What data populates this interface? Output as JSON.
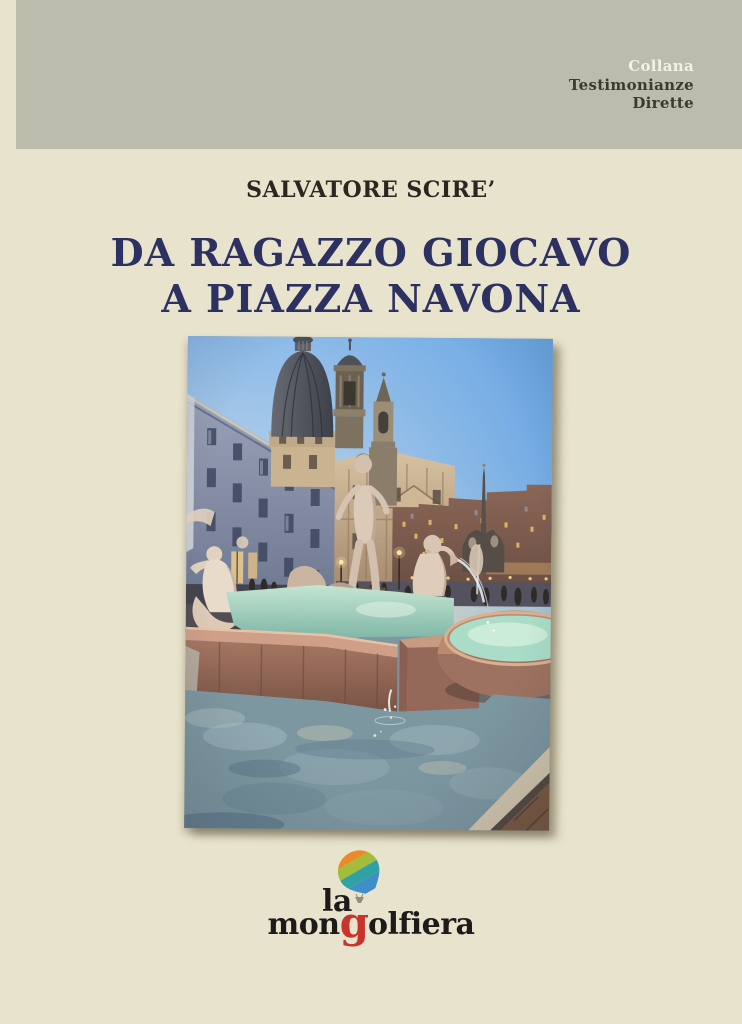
{
  "banner": {
    "line1": "Collana",
    "line2": "Testimonianze",
    "line3": "Dirette"
  },
  "author": "SALVATORE SCIRE’",
  "title": {
    "line1": "DA RAGAZZO GIOCAVO",
    "line2": "A PIAZZA NAVONA"
  },
  "logo": {
    "la": "la",
    "part1": "mon",
    "part2": "g",
    "part3": "olfiera"
  },
  "colors": {
    "page_bg": "#e8e3cc",
    "band_bg": "#bbbcab",
    "band_text": "#3a3a31",
    "collana_text": "#f4f1e2",
    "author_text": "#2b2620",
    "title_text": "#2c3162",
    "logo_text": "#1d1b19",
    "logo_g": "#c8332c",
    "balloon_stripe1": "#d9382d",
    "balloon_stripe2": "#ea8a28",
    "balloon_stripe3": "#a4bc3c",
    "balloon_stripe4": "#2fa3a4",
    "balloon_stripe5": "#3f8fc6",
    "balloon_basket": "#8f8d7f"
  }
}
